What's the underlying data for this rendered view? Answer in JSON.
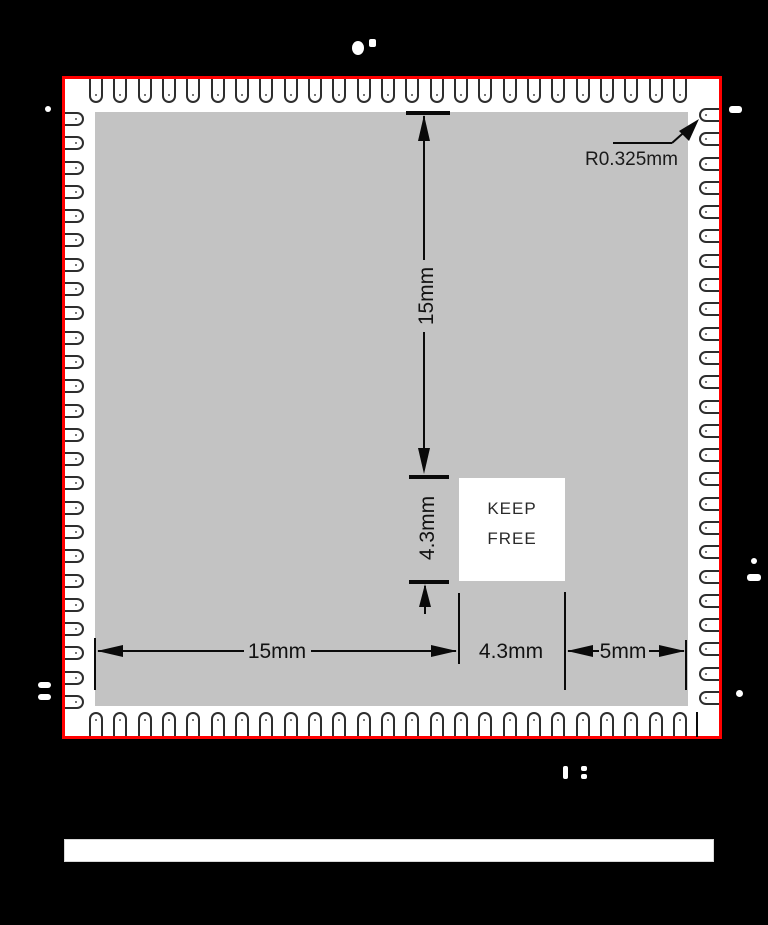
{
  "drawing": {
    "type": "module-footprint-dimension-drawing",
    "pads_per_edge": {
      "top": 25,
      "bottom": 25,
      "left": 25,
      "right": 25
    },
    "labels": {
      "dim_vertical_15": "15mm",
      "dim_vertical_43": "4.3mm",
      "dim_horizontal_15": "15mm",
      "dim_horizontal_43": "4.3mm",
      "dim_horizontal_5": "5mm",
      "corner_radius": "R0.325mm"
    },
    "keep_free": {
      "line1": "KEEP",
      "line2": "FREE"
    }
  },
  "colors": {
    "background": "#000000",
    "module_outline": "#ff0000",
    "module_body": "#c3c3c3",
    "pad_fill": "#ffffff",
    "linework": "#0a0a0a"
  }
}
